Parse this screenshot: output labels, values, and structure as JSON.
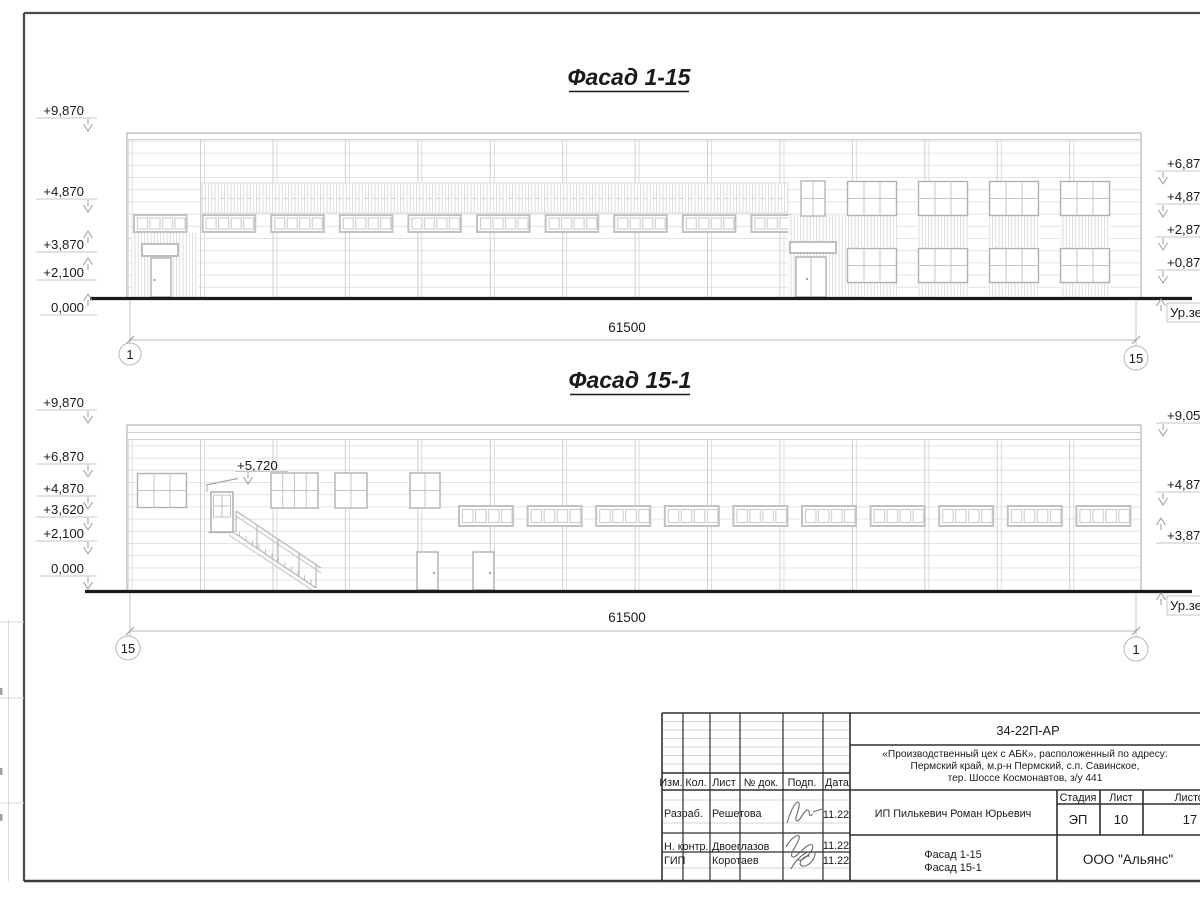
{
  "facade1": {
    "title": "Фасад 1-15",
    "left_marks": [
      "+9,870",
      "+4,870",
      "+3,870",
      "+2,100",
      "0,000"
    ],
    "right_marks": [
      "+6,87",
      "+4,87",
      "+2,87",
      "+0,87"
    ],
    "ground_label": "Ур.зе",
    "dimension": "61500",
    "axis_left": "1",
    "axis_right": "15"
  },
  "facade2": {
    "title": "Фасад 15-1",
    "left_marks": [
      "+9,870",
      "+6,870",
      "+4,870",
      "+3,620",
      "+2,100",
      "0,000"
    ],
    "stair_mark": "+5,720",
    "right_marks": [
      "+9,05",
      "+4,87",
      "+3,87"
    ],
    "ground_label": "Ур.зе",
    "dimension": "61500",
    "axis_left": "15",
    "axis_right": "1"
  },
  "titleblock": {
    "doc_code": "34-22П-АР",
    "object_line1": "«Производственный цех с АБК», расположенный по адресу:",
    "object_line2": "Пермский край, м.р-н Пермский, с.п. Савинское,",
    "object_line3": "тер. Шоссе Космонавтов, з/у 441",
    "col_izm": "Изм.",
    "col_kol": "Кол.",
    "col_list": "Лист",
    "col_dok": "№ док.",
    "col_podp": "Подп.",
    "col_data": "Дата",
    "rows": [
      {
        "role": "Разраб.",
        "name": "Решетова",
        "date": "11.22"
      },
      {
        "role": "Н. контр.",
        "name": "Двоеглазов",
        "date": "11.22"
      },
      {
        "role": "ГИП",
        "name": "Коротаев",
        "date": "11.22"
      }
    ],
    "client": "ИП Пилькевич Роман Юрьевич",
    "stage_label": "Стадия",
    "sheet_label": "Лист",
    "sheets_label": "Листов",
    "stage": "ЭП",
    "sheet": "10",
    "sheets": "17",
    "sheet_title_line1": "Фасад 1-15",
    "sheet_title_line2": "Фасад 15-1",
    "org": "ООО \"Альянс\""
  }
}
